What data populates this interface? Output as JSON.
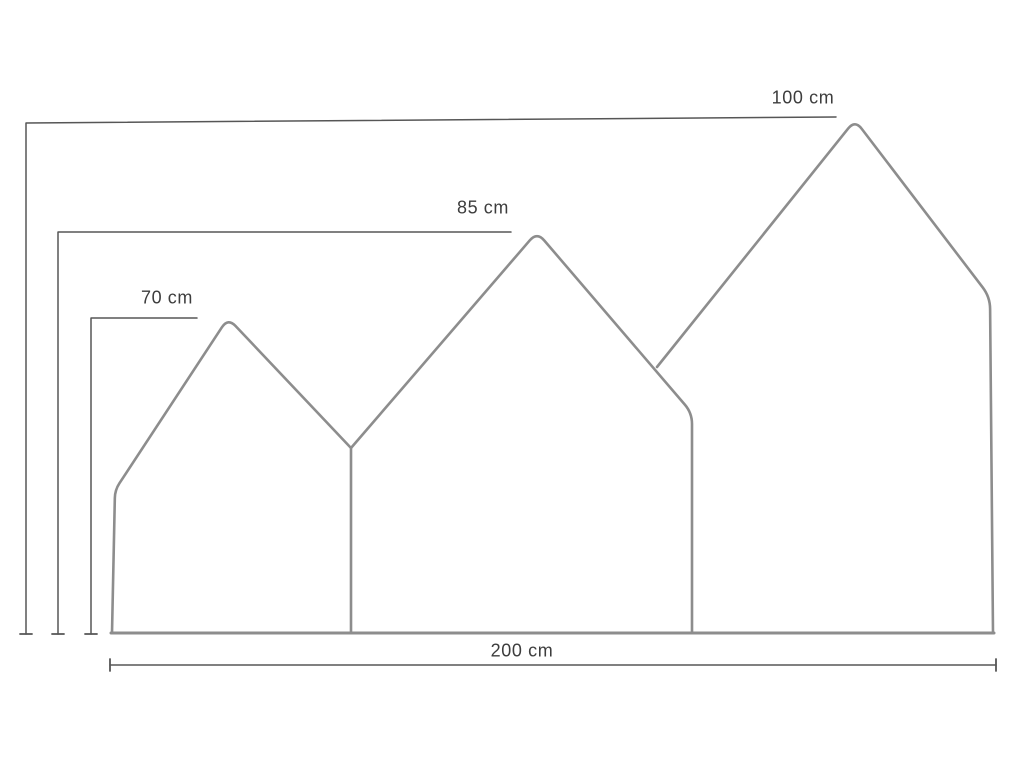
{
  "page": {
    "background": "#ffffff"
  },
  "units": "cm",
  "measurements": {
    "panel_heights_cm": [
      70,
      85,
      100
    ],
    "total_width_cm": 200
  },
  "labels": {
    "h100": {
      "text": "100 cm",
      "x": 803,
      "y": 98
    },
    "h85": {
      "text": "85 cm",
      "x": 483,
      "y": 208
    },
    "h70": {
      "text": "70 cm",
      "x": 167,
      "y": 298
    },
    "w200": {
      "text": "200 cm",
      "x": 522,
      "y": 651
    }
  },
  "drawing": {
    "width": 1024,
    "height": 768,
    "colors": {
      "outline": "#8d8d8d",
      "dimension": "#565656",
      "text": "#3d3d3d"
    },
    "outline_width": 2.6,
    "baseline_width": 3,
    "dimension_width": 1.5,
    "panels": [
      {
        "name": "small-panel-outline",
        "points": [
          {
            "x": 112,
            "y": 633
          },
          {
            "x": 115,
            "y": 490,
            "r": 8
          },
          {
            "x": 228,
            "y": 318,
            "r": 11
          },
          {
            "x": 351,
            "y": 448
          },
          {
            "x": 351,
            "y": 633
          }
        ]
      },
      {
        "name": "middle-panel-outline",
        "points": [
          {
            "x": 351,
            "y": 448
          },
          {
            "x": 537,
            "y": 232,
            "r": 11
          },
          {
            "x": 692,
            "y": 413,
            "r": 11
          },
          {
            "x": 692,
            "y": 633
          }
        ]
      },
      {
        "name": "large-panel-outline",
        "points": [
          {
            "x": 657,
            "y": 367
          },
          {
            "x": 855,
            "y": 120,
            "r": 11
          },
          {
            "x": 990,
            "y": 297,
            "r": 12
          },
          {
            "x": 993,
            "y": 633
          }
        ]
      }
    ],
    "baseline": {
      "name": "baseline",
      "points": [
        {
          "x": 111,
          "y": 633
        },
        {
          "x": 994,
          "y": 633
        }
      ]
    },
    "dimension_lines": [
      {
        "name": "dim-height-100",
        "points": [
          {
            "x": 836,
            "y": 117
          },
          {
            "x": 26,
            "y": 123
          },
          {
            "x": 26,
            "y": 634
          }
        ],
        "ticks": [
          {
            "x1": 20,
            "y1": 634,
            "x2": 32,
            "y2": 634
          }
        ]
      },
      {
        "name": "dim-height-85",
        "points": [
          {
            "x": 511,
            "y": 232
          },
          {
            "x": 58,
            "y": 232
          },
          {
            "x": 58,
            "y": 634
          }
        ],
        "ticks": [
          {
            "x1": 52,
            "y1": 634,
            "x2": 64,
            "y2": 634
          }
        ]
      },
      {
        "name": "dim-height-70",
        "points": [
          {
            "x": 197,
            "y": 318
          },
          {
            "x": 91,
            "y": 318
          },
          {
            "x": 91,
            "y": 634
          }
        ],
        "ticks": [
          {
            "x1": 85,
            "y1": 634,
            "x2": 97,
            "y2": 634
          }
        ]
      },
      {
        "name": "dim-width-200",
        "points": [
          {
            "x": 110,
            "y": 665
          },
          {
            "x": 996,
            "y": 665
          }
        ],
        "ticks": [
          {
            "x1": 110,
            "y1": 659,
            "x2": 110,
            "y2": 671
          },
          {
            "x1": 996,
            "y1": 659,
            "x2": 996,
            "y2": 671
          }
        ]
      }
    ]
  }
}
